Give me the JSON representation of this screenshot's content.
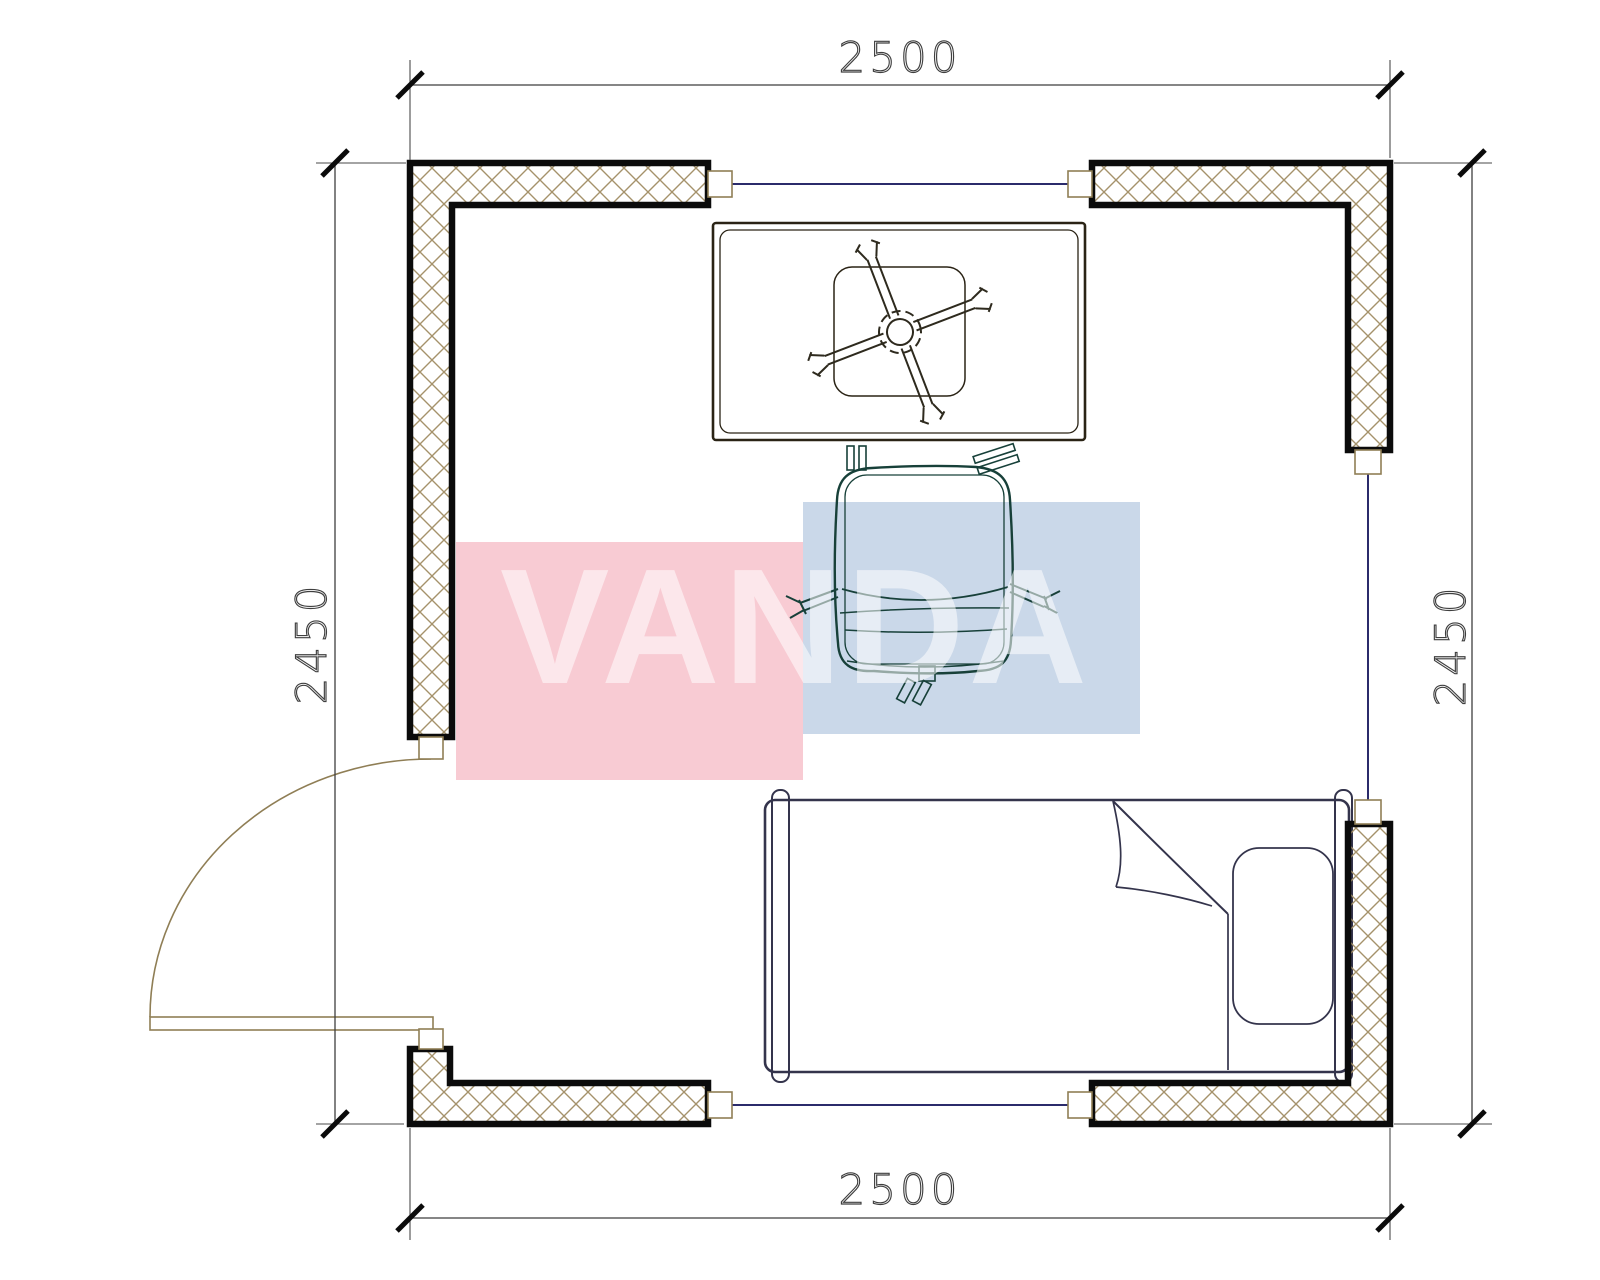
{
  "plan": {
    "dimension_labels": {
      "top": "2500",
      "bottom": "2500",
      "left": "2450",
      "right": "2450"
    }
  },
  "watermark": {
    "text": "VANDA",
    "text_color": "#FFFFFF",
    "red_block_color": "#F8CBD3",
    "blue_block_color": "#CAD8E9"
  },
  "colors": {
    "desk": "#C1903F",
    "chair": "#549E8C",
    "bed": "#A28B96",
    "bed_rail": "#998291",
    "pillow": "#A28B96",
    "watermark_red": "#F8CBD3",
    "watermark_blue": "#CAD8E9",
    "glazing": "#2B2B6B",
    "hatch": "#A5926B",
    "joinery": "#8F7E55",
    "wall_outline": "#0B0B0B",
    "dimension": "#3F3F3F"
  }
}
